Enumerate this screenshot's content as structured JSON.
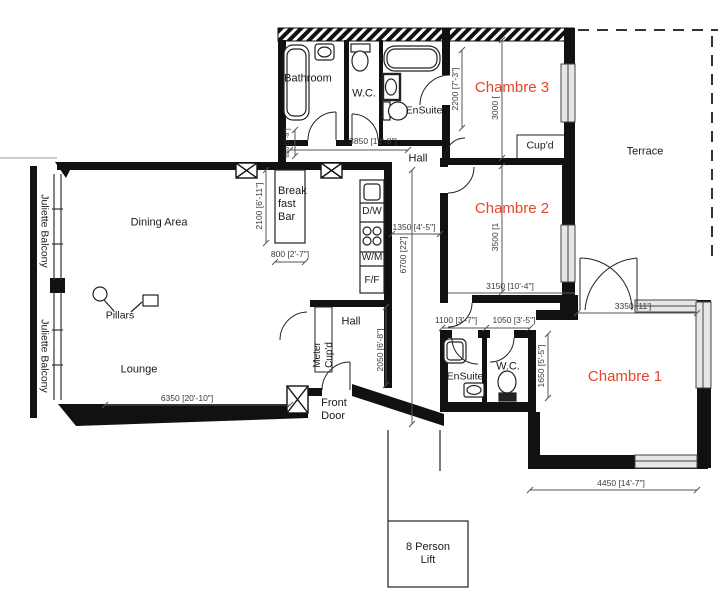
{
  "accent_color": "#e8442a",
  "labels": {
    "bathroom": "Bathroom",
    "wc_top": "W.C.",
    "ensuite_top": "EnSuite",
    "chambre3": "Chambre 3",
    "cupd": "Cup'd",
    "terrace": "Terrace",
    "hall_top": "Hall",
    "dining_area": "Dining Area",
    "breakfast_line1": "Break",
    "breakfast_line2": "fast",
    "breakfast_line3": "Bar",
    "chambre2": "Chambre 2",
    "pillars": "Pillars",
    "lounge": "Lounge",
    "juliette_balcony_upper": "Juliette Balcony",
    "juliette_balcony_lower": "Juliette Balcony",
    "hall_mid": "Hall",
    "meter_line1": "Meter",
    "meter_line2": "Cup'd",
    "front_door_line1": "Front",
    "front_door_line2": "Door",
    "ensuite_bottom": "EnSuite",
    "wc_bottom": "W.C.",
    "chambre1": "Chambre 1",
    "lift_line1": "8 Person",
    "lift_line2": "Lift",
    "appliance_dw": "D/W",
    "appliance_wm": "W/M",
    "appliance_ff": "F/F"
  },
  "dimensions": {
    "bath_block_width": "3850 [12'-8\"]",
    "hall_nook": "850 [2'-9\"]",
    "ensuite_height": "2200 [7'-3\"]",
    "chambre3_width": "3000 [",
    "chambre2_height": "3500 [1",
    "chambre2_width": "3150 [10'-4\"]",
    "ensuite2_width": "1100 [3'-7\"]",
    "wc2_width": "1050 [3'-5\"]",
    "wc_block_height": "1650 [5'-5\"]",
    "chambre1_top_width": "3350 [11']",
    "chambre1_bottom_width": "4450 [14'-7\"]",
    "lounge_width": "6350 [20'-10\"]",
    "breakfast_bar_length": "2100 [6'-11\"]",
    "breakfast_bar_width": "800 [2'-7\"]",
    "hall_width": "1350 [4'-5\"]",
    "hall_length": "6700 [22']",
    "hall_mid_height": "2050 [6'-8\"]"
  }
}
